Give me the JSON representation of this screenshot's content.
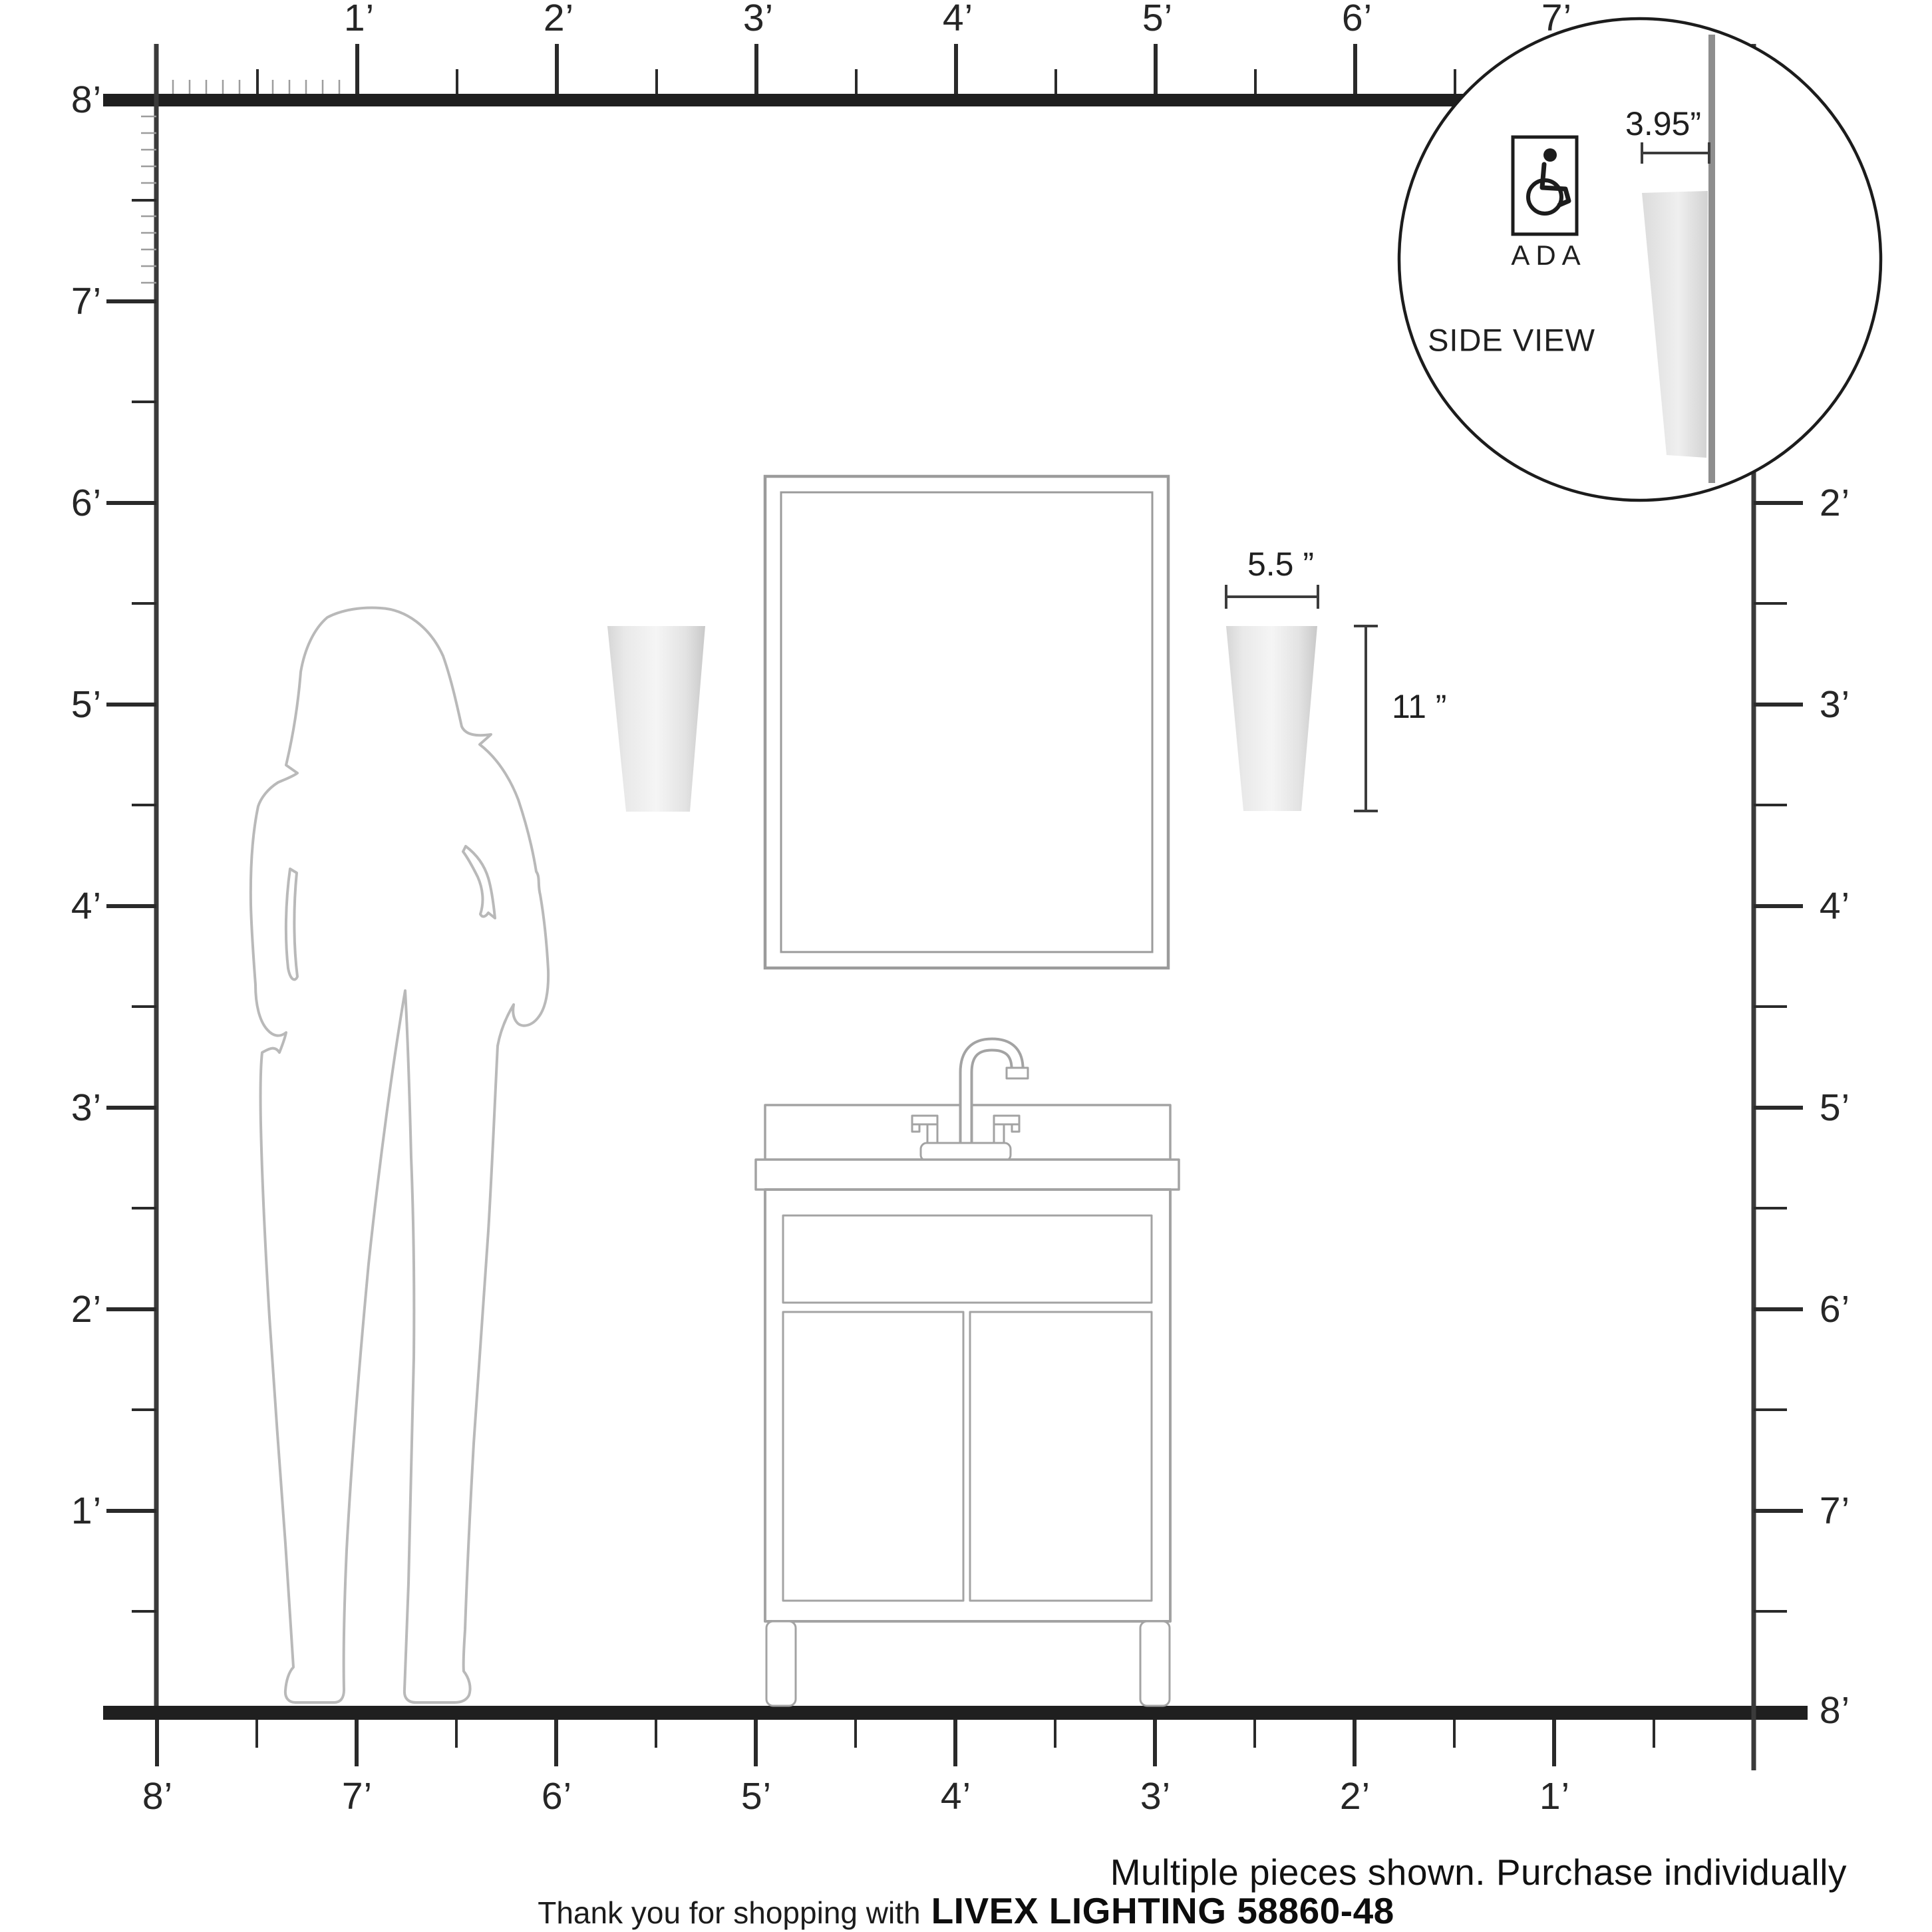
{
  "diagram_type": "product scale / dimension diagram",
  "rulers": {
    "unit": "feet",
    "top": [
      "1’",
      "2’",
      "3’",
      "4’",
      "5’",
      "6’",
      "7’"
    ],
    "left": [
      "8’",
      "7’",
      "6’",
      "5’",
      "4’",
      "3’",
      "2’",
      "1’"
    ],
    "right": [
      "2’",
      "3’",
      "4’",
      "5’",
      "6’",
      "7’",
      "8’"
    ],
    "bottom": [
      "8’",
      "7’",
      "6’",
      "5’",
      "4’",
      "3’",
      "2’",
      "1’"
    ]
  },
  "fixture_dimensions": {
    "width": "5.5 ”",
    "height": "11 ”"
  },
  "inset": {
    "ada_label": "ADA",
    "side_view_label": "SIDE VIEW",
    "depth_dimension": "3.95”"
  },
  "footer": {
    "note": "Multiple pieces shown. Purchase individually",
    "thanks_prefix": "Thank you for shopping with",
    "brand_model": "LIVEX LIGHTING 58860-48"
  },
  "colors": {
    "ink": "#1f1f1f",
    "outline_gray": "#a3a3a3",
    "silhouette_gray": "#b9b9b9",
    "wall_gray": "#8e8e8e",
    "shade_light": "#f2f2f2",
    "shade_dark": "#cfcfcf"
  }
}
